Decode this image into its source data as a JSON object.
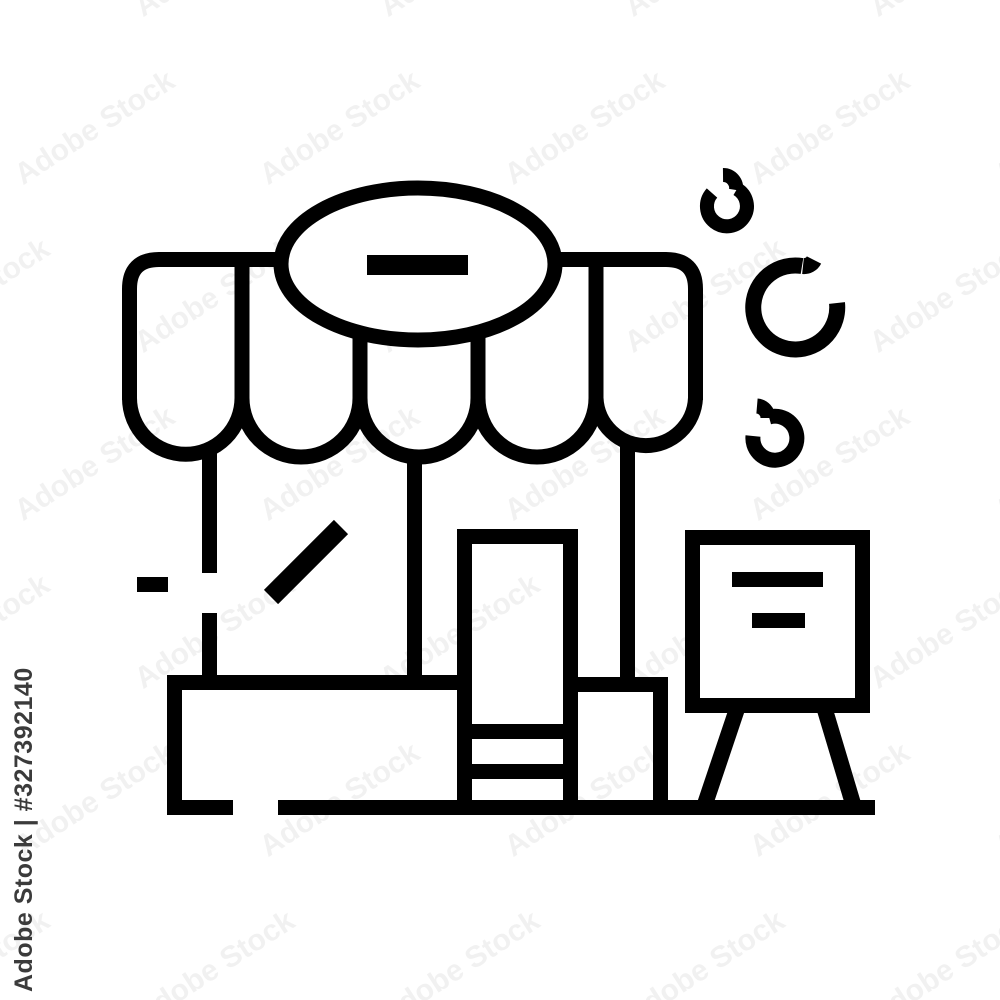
{
  "colors": {
    "background": "#ffffff",
    "line": "#000000",
    "watermark_tile": "rgba(0,0,0,0.055)",
    "credit_text_color": "#3b3b3b"
  },
  "watermark": {
    "tile_text": "Adobe Stock",
    "credit_text": "Adobe Stock | #327392140"
  },
  "icon": {
    "name": "storefront-shop-line-icon",
    "style": "black outline / line art on white",
    "parts": [
      "scalloped-awning",
      "oval-sign-with-minus",
      "shop-wall-posts",
      "window-shine-diagonal",
      "door-with-steps",
      "left-display-platform",
      "right-display-platform",
      "ground-line",
      "a-frame-sidewalk-sign",
      "decorative-swirl-small-top",
      "decorative-swirl-large-middle",
      "decorative-swirl-small-bottom"
    ]
  }
}
